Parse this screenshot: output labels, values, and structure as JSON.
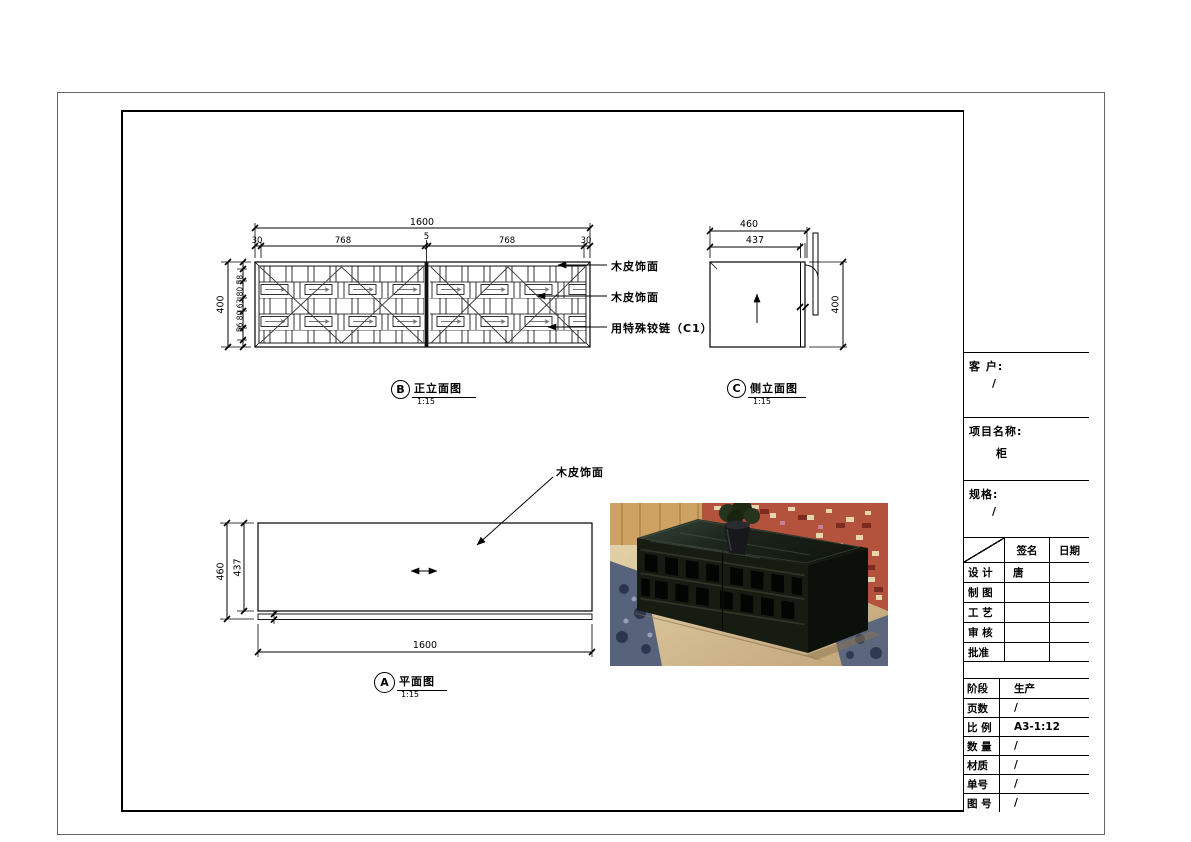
{
  "drawing": {
    "front": {
      "letter": "B",
      "title": "正立面图",
      "scale": "1:15",
      "dim_width_total": "1600",
      "dim_seg_left_end": "30",
      "dim_seg_left_door": "768",
      "dim_seg_center": "5",
      "dim_seg_right_door": "768",
      "dim_seg_right_end": "30",
      "dim_height": "400",
      "dim_height_stack": "56 80 63 80 58",
      "callout_top": "木皮饰面",
      "callout_mid": "木皮饰面",
      "callout_hinge": "用特殊铰链（C1）"
    },
    "side": {
      "letter": "C",
      "title": "侧立面图",
      "scale": "1:15",
      "dim_depth_total": "460",
      "dim_depth_inner": "437",
      "dim_height": "400"
    },
    "plan": {
      "letter": "A",
      "title": "平面图",
      "scale": "1:15",
      "dim_depth_total": "460",
      "dim_depth_inner": "437",
      "dim_width": "1600",
      "callout": "木皮饰面"
    }
  },
  "title_block": {
    "client_label": "客 户:",
    "client_value": "/",
    "project_label": "项目名称:",
    "project_value": "柜",
    "spec_label": "规格:",
    "spec_value": "/",
    "sign_col": "签名",
    "date_col": "日期",
    "rows": [
      {
        "label": "设 计",
        "sign": "唐",
        "date": ""
      },
      {
        "label": "制 图",
        "sign": "",
        "date": ""
      },
      {
        "label": "工 艺",
        "sign": "",
        "date": ""
      },
      {
        "label": "审 核",
        "sign": "",
        "date": ""
      },
      {
        "label": "批准",
        "sign": "",
        "date": ""
      }
    ],
    "info": [
      {
        "label": "阶段",
        "value": "生产"
      },
      {
        "label": "页数",
        "value": "/"
      },
      {
        "label": "比 例",
        "value": "A3-1:12"
      },
      {
        "label": "数 量",
        "value": "/"
      },
      {
        "label": "材质",
        "value": "/"
      },
      {
        "label": "单号",
        "value": "/"
      },
      {
        "label": "图 号",
        "value": "/"
      }
    ]
  },
  "photo": {
    "colors": {
      "floor": "#d8c296",
      "rug": "#b8543f",
      "carpet": "#58647a",
      "cabinet": "#151a12"
    }
  }
}
